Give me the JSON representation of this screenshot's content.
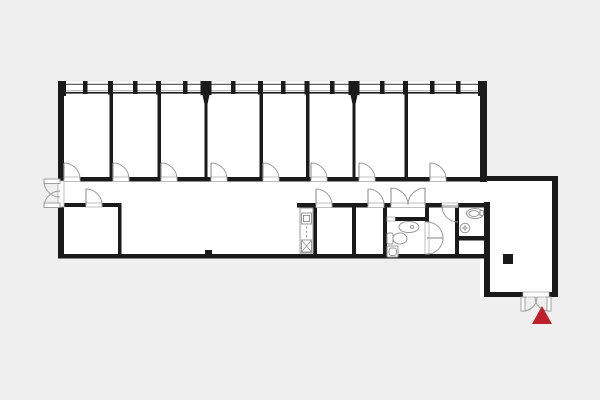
{
  "canvas": {
    "width": 600,
    "height": 400,
    "background": "#efefef",
    "floor_color": "#ffffff",
    "wall_color": "#1a1a1a",
    "fixture_line_color": "#9a9a9a",
    "threshold_line_color": "#b0b0b0",
    "window_line_top_color": "#4a4a4a",
    "window_line_mid_color": "#aaaaaa",
    "window_line_bottom_color": "#222222",
    "marker_color": "#bf1f2b"
  },
  "floor_plan": {
    "floor_rects": [
      [
        58,
        82,
        429,
        176
      ],
      [
        480,
        176,
        78,
        121
      ]
    ],
    "window_band": {
      "x1": 58,
      "x2": 487,
      "top_y": 84.3,
      "mid_y": 90.8,
      "bottom_y": 92.8
    },
    "walls": [
      [
        58,
        82,
        6,
        99
      ],
      [
        58,
        205,
        6,
        53
      ],
      [
        58,
        254,
        432,
        4.5
      ],
      [
        480,
        82,
        7,
        100
      ],
      [
        480,
        176,
        78,
        5
      ],
      [
        552,
        176,
        6,
        121
      ],
      [
        484,
        292,
        39,
        5
      ],
      [
        549,
        292,
        9,
        5
      ],
      [
        484,
        202,
        6,
        95
      ],
      [
        58,
        177,
        6,
        4.5
      ],
      [
        80,
        177,
        33,
        4.5
      ],
      [
        129,
        177,
        32,
        4.5
      ],
      [
        177,
        177,
        34,
        4.5
      ],
      [
        227,
        177,
        36,
        4.5
      ],
      [
        279,
        177,
        32,
        4.5
      ],
      [
        327,
        177,
        32,
        4.5
      ],
      [
        375,
        177,
        55,
        4.5
      ],
      [
        446,
        177,
        37,
        4.5
      ],
      [
        297,
        203,
        19,
        4.5
      ],
      [
        332,
        203,
        36,
        4.5
      ],
      [
        384,
        203,
        7,
        4.5
      ],
      [
        425,
        203,
        17,
        4.5
      ],
      [
        455,
        203,
        33,
        4.5
      ],
      [
        62,
        203,
        24,
        4
      ],
      [
        102,
        203,
        19,
        4
      ],
      [
        118,
        203,
        3.5,
        55
      ],
      [
        313,
        203,
        4,
        55
      ],
      [
        352,
        203,
        4,
        55
      ],
      [
        383,
        203,
        4,
        55
      ],
      [
        395,
        217,
        33,
        4
      ],
      [
        425,
        203,
        4,
        19
      ],
      [
        455,
        203,
        4,
        55
      ],
      [
        459,
        236,
        25,
        4.5
      ],
      [
        205,
        250,
        7,
        5
      ],
      [
        109.5,
        93,
        3.5,
        88
      ],
      [
        157.5,
        93,
        3.5,
        88
      ],
      [
        259.5,
        93,
        3.5,
        88
      ],
      [
        306,
        93,
        3.5,
        88
      ],
      [
        404.5,
        93,
        3.5,
        88
      ],
      [
        204.5,
        104,
        3,
        77
      ],
      [
        352.5,
        104,
        3,
        77
      ]
    ],
    "piers": [
      [
        83,
        81,
        4.5,
        13
      ],
      [
        133,
        81,
        4.5,
        13
      ],
      [
        183,
        81,
        4.5,
        13
      ],
      [
        231,
        81,
        4.5,
        13
      ],
      [
        281,
        81,
        4.5,
        13
      ],
      [
        330,
        81,
        4.5,
        13
      ],
      [
        380,
        81,
        4.5,
        13
      ],
      [
        430,
        81,
        4.5,
        13
      ],
      [
        456,
        81,
        4.5,
        13
      ],
      [
        108,
        81,
        5,
        13.5
      ],
      [
        156,
        81,
        5,
        13.5
      ],
      [
        258,
        81,
        5,
        13.5
      ],
      [
        304.5,
        81,
        5,
        13.5
      ],
      [
        403,
        81,
        5,
        13.5
      ],
      [
        200.5,
        81,
        11,
        14
      ],
      [
        348.5,
        81,
        11,
        14
      ],
      [
        58,
        81,
        8,
        15
      ],
      [
        478,
        81,
        9,
        15
      ]
    ],
    "tapers": [
      "202.5,95 209.5,95 207.5,104 204.5,104",
      "350.5,95 357.5,95 355.5,104 352.5,104"
    ],
    "thresholds": [
      [
        64,
        177,
        16,
        4.5
      ],
      [
        113,
        177,
        16,
        4.5
      ],
      [
        161,
        177,
        16,
        4.5
      ],
      [
        211,
        177,
        16,
        4.5
      ],
      [
        263,
        177,
        16,
        4.5
      ],
      [
        311,
        177,
        16,
        4.5
      ],
      [
        359,
        177,
        16,
        4.5
      ],
      [
        430,
        177,
        16,
        4.5
      ],
      [
        316,
        203,
        16,
        4.5
      ],
      [
        368,
        203,
        16,
        4.5
      ],
      [
        391,
        203,
        34,
        4.5
      ],
      [
        442,
        203,
        16,
        4.5
      ],
      [
        86,
        203,
        16,
        4
      ],
      [
        58,
        181,
        6,
        26
      ],
      [
        523,
        292,
        26,
        5
      ],
      [
        387,
        217,
        8,
        4
      ],
      [
        425,
        222,
        4,
        32
      ]
    ],
    "doors": [
      {
        "leaf": [
          64,
          179,
          64,
          163
        ],
        "arc": "M 64 163 A 16 16 0 0 1 80 179"
      },
      {
        "leaf": [
          113,
          179,
          113,
          163
        ],
        "arc": "M 113 163 A 16 16 0 0 1 129 179"
      },
      {
        "leaf": [
          161,
          179,
          161,
          163
        ],
        "arc": "M 161 163 A 16 16 0 0 1 177 179"
      },
      {
        "leaf": [
          211,
          179,
          211,
          163
        ],
        "arc": "M 211 163 A 16 16 0 0 1 227 179"
      },
      {
        "leaf": [
          263,
          179,
          263,
          163
        ],
        "arc": "M 263 163 A 16 16 0 0 1 279 179"
      },
      {
        "leaf": [
          311,
          179,
          311,
          163
        ],
        "arc": "M 311 163 A 16 16 0 0 1 327 179"
      },
      {
        "leaf": [
          359,
          179,
          359,
          163
        ],
        "arc": "M 359 163 A 16 16 0 0 1 375 179"
      },
      {
        "leaf": [
          430,
          179,
          430,
          163
        ],
        "arc": "M 430 163 A 16 16 0 0 1 446 179"
      },
      {
        "leaf": [
          86,
          205,
          86,
          189
        ],
        "arc": "M 86 189 A 16 16 0 0 1 102 205"
      },
      {
        "leaf": [
          316,
          205,
          316,
          189
        ],
        "arc": "M 316 189 A 16 16 0 0 1 332 205"
      },
      {
        "leaf": [
          368,
          205,
          368,
          189
        ],
        "arc": "M 368 189 A 16 16 0 0 1 384 205"
      },
      {
        "leaf": [
          391,
          205,
          391,
          188
        ],
        "arc": "M 391 188 A 17 17 0 0 1 408 205"
      },
      {
        "leaf": [
          425,
          205,
          425,
          188
        ],
        "arc": "M 425 188 A 17 17 0 0 0 408 205"
      },
      {
        "leaf": [
          458,
          206,
          442,
          206
        ],
        "arc": "M 442 206 A 16 16 0 0 0 458 222"
      },
      {
        "leaf": [
          427,
          238,
          443,
          238
        ],
        "arc": "M 427 222 A 16 16 0 0 1 427 254"
      },
      {
        "leaf_rect": [
          44,
          179,
          16,
          4.5
        ],
        "arc": "M 44 181 A 16 16 0 0 0 60 197"
      },
      {
        "leaf_rect": [
          44,
          203,
          16,
          4.5
        ],
        "arc": "M 44 207 A 16 16 0 0 1 60 191"
      },
      {
        "leaf_rect": [
          521,
          297,
          4,
          14
        ],
        "arc": "M 523 311 A 14 14 0 0 0 537 297"
      },
      {
        "leaf_rect": [
          547,
          297,
          4,
          14
        ],
        "arc": "M 549 311 A 14 14 0 0 1 535 297"
      }
    ],
    "fixtures": [
      {
        "name": "kitchen-counter",
        "rect": [
          300,
          208,
          13,
          45,
          0
        ]
      },
      {
        "name": "kitchen-sink",
        "rect": [
          301.5,
          213,
          10,
          11,
          0
        ]
      },
      {
        "name": "kitchen-sink-basin",
        "rect": [
          303.5,
          215.5,
          6,
          6,
          0
        ]
      },
      {
        "name": "kitchen-cabinet",
        "rect": [
          301.5,
          240,
          10,
          12,
          0
        ]
      },
      {
        "name": "kitchen-cabinet-diagonal",
        "line": [
          301.5,
          252,
          311.5,
          240
        ]
      },
      {
        "name": "kitchen-cabinet-diagonal",
        "line": [
          301.5,
          240,
          311.5,
          252
        ]
      },
      {
        "name": "kitchen-counter-divider",
        "dline": [
          306.5,
          226,
          306.5,
          239
        ]
      },
      {
        "name": "bathroom-sink",
        "ellipse": [
          409,
          227,
          10,
          5.5
        ]
      },
      {
        "name": "bathroom-sink-drain",
        "circle": [
          412,
          227,
          1.5
        ]
      },
      {
        "name": "toilet-tank",
        "rect": [
          387,
          233,
          6,
          11,
          1.5
        ]
      },
      {
        "name": "toilet-bowl",
        "ellipse": [
          400,
          238.5,
          7,
          5.5
        ]
      },
      {
        "name": "shower-tray",
        "rect": [
          387,
          246,
          11,
          11,
          1
        ]
      },
      {
        "name": "shower-tray-inner",
        "rect": [
          389,
          248,
          7.5,
          7.5,
          2.5
        ]
      },
      {
        "name": "wc-sink",
        "ellipse": [
          475,
          213.5,
          8.5,
          5
        ]
      },
      {
        "name": "wc-sink-inner",
        "ellipse": [
          474,
          213.5,
          5,
          3
        ]
      },
      {
        "name": "wc-tap",
        "rect": [
          480,
          210.5,
          3.5,
          5,
          0.5
        ]
      },
      {
        "name": "wc-basin",
        "circle": [
          465,
          228,
          4.8
        ]
      },
      {
        "name": "wc-basin-cross",
        "line": [
          462,
          228,
          468,
          228
        ]
      },
      {
        "name": "wc-basin-cross",
        "line": [
          465,
          225,
          465,
          231
        ]
      },
      {
        "name": "wc-basin-center",
        "circle": [
          465,
          228,
          1.2
        ]
      }
    ],
    "column": [
      503,
      254,
      10,
      10
    ],
    "entrance_marker": {
      "points": "542,306 532,324 552,324"
    }
  }
}
